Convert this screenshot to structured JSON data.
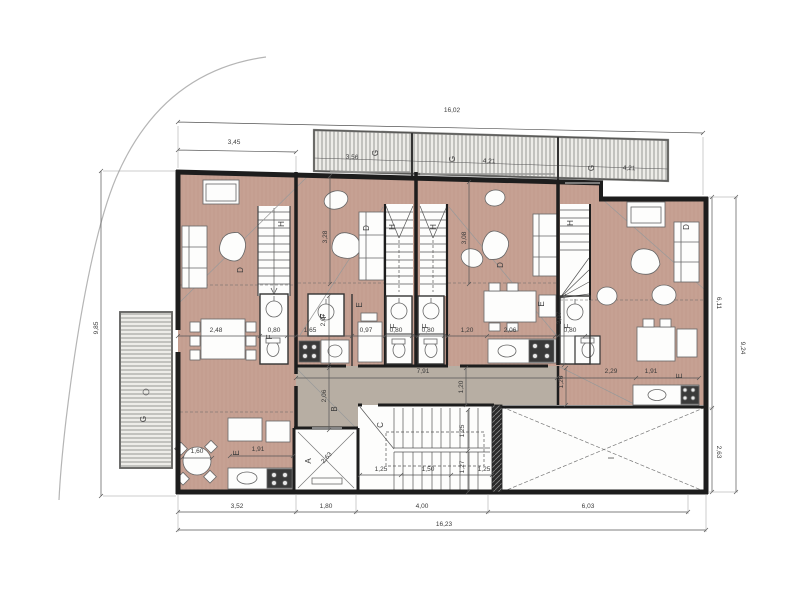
{
  "meta": {
    "type": "architectural-floor-plan",
    "view": "upper floor plan with four dwelling units, stair core, elevator and terraces"
  },
  "colors": {
    "floor_wood": "#c6a193",
    "corridor": "#b7aea3",
    "wall": "#1d1d1d",
    "terrace_bg": "#edece8",
    "hatch_line": "#8e8e8c",
    "dim_line": "#555555",
    "dim_text": "#3a3a3a",
    "white_room": "#fdfdfc",
    "site_line": "#b5b5b5"
  },
  "room_labels": [
    {
      "text": "A",
      "x": 311,
      "y": 461,
      "rot": -90
    },
    {
      "text": "B",
      "x": 337,
      "y": 409,
      "rot": -90
    },
    {
      "text": "C",
      "x": 383,
      "y": 425,
      "rot": -90
    },
    {
      "text": "D",
      "x": 243,
      "y": 270,
      "rot": -90
    },
    {
      "text": "D",
      "x": 369,
      "y": 228,
      "rot": -90
    },
    {
      "text": "D",
      "x": 503,
      "y": 265,
      "rot": -90
    },
    {
      "text": "D",
      "x": 689,
      "y": 227,
      "rot": -90
    },
    {
      "text": "E",
      "x": 239,
      "y": 453,
      "rot": -90
    },
    {
      "text": "E",
      "x": 362,
      "y": 305,
      "rot": -90
    },
    {
      "text": "E",
      "x": 544,
      "y": 304,
      "rot": -90
    },
    {
      "text": "E",
      "x": 682,
      "y": 376,
      "rot": -90
    },
    {
      "text": "F",
      "x": 272,
      "y": 337,
      "rot": -90
    },
    {
      "text": "F",
      "x": 326,
      "y": 316,
      "rot": -90
    },
    {
      "text": "F",
      "x": 396,
      "y": 326,
      "rot": -90
    },
    {
      "text": "F",
      "x": 428,
      "y": 326,
      "rot": -90
    },
    {
      "text": "F",
      "x": 570,
      "y": 326,
      "rot": -90
    },
    {
      "text": "G",
      "x": 378,
      "y": 153,
      "rot": -90
    },
    {
      "text": "G",
      "x": 455,
      "y": 159,
      "rot": -90
    },
    {
      "text": "G",
      "x": 594,
      "y": 168,
      "rot": -90
    },
    {
      "text": "G",
      "x": 146,
      "y": 419,
      "rot": -90
    },
    {
      "text": "H",
      "x": 284,
      "y": 224,
      "rot": -90
    },
    {
      "text": "H",
      "x": 395,
      "y": 227,
      "rot": -90
    },
    {
      "text": "H",
      "x": 436,
      "y": 227,
      "rot": -90
    },
    {
      "text": "H",
      "x": 573,
      "y": 223,
      "rot": -90
    },
    {
      "text": "I",
      "x": 614,
      "y": 458,
      "rot": -90
    }
  ],
  "dim_labels": [
    {
      "text": "16,02",
      "x": 452,
      "y": 112,
      "rot": 1
    },
    {
      "text": "3,45",
      "x": 234,
      "y": 144,
      "rot": 1
    },
    {
      "text": "3,56",
      "x": 352,
      "y": 159,
      "rot": 2
    },
    {
      "text": "4,21",
      "x": 489,
      "y": 163,
      "rot": 2
    },
    {
      "text": "4,21",
      "x": 629,
      "y": 170,
      "rot": 2
    },
    {
      "text": "9,85",
      "x": 98,
      "y": 328,
      "rot": -90
    },
    {
      "text": "6,11",
      "x": 717,
      "y": 303,
      "rot": 90
    },
    {
      "text": "9,24",
      "x": 741,
      "y": 348,
      "rot": 90
    },
    {
      "text": "2,63",
      "x": 717,
      "y": 452,
      "rot": 90
    },
    {
      "text": "3,52",
      "x": 237,
      "y": 508,
      "rot": 0
    },
    {
      "text": "1,80",
      "x": 326,
      "y": 508,
      "rot": 0
    },
    {
      "text": "4,00",
      "x": 422,
      "y": 508,
      "rot": 0
    },
    {
      "text": "6,03",
      "x": 588,
      "y": 508,
      "rot": 0
    },
    {
      "text": "16,23",
      "x": 444,
      "y": 526,
      "rot": 0
    },
    {
      "text": "2,48",
      "x": 216,
      "y": 332,
      "rot": 0
    },
    {
      "text": "0,80",
      "x": 274,
      "y": 332,
      "rot": 0
    },
    {
      "text": "1,65",
      "x": 310,
      "y": 332,
      "rot": 0
    },
    {
      "text": "0,97",
      "x": 366,
      "y": 332,
      "rot": 0
    },
    {
      "text": "0,80",
      "x": 396,
      "y": 332,
      "rot": 0
    },
    {
      "text": "0,80",
      "x": 428,
      "y": 332,
      "rot": 0
    },
    {
      "text": "1,20",
      "x": 467,
      "y": 332,
      "rot": 0
    },
    {
      "text": "2,06",
      "x": 510,
      "y": 332,
      "rot": 0
    },
    {
      "text": "0,80",
      "x": 570,
      "y": 332,
      "rot": 0
    },
    {
      "text": "2,07",
      "x": 325,
      "y": 320,
      "rot": -90
    },
    {
      "text": "2,07",
      "x": 561,
      "y": 318,
      "rot": -90
    },
    {
      "text": "3,28",
      "x": 327,
      "y": 237,
      "rot": -90
    },
    {
      "text": "3,08",
      "x": 466,
      "y": 238,
      "rot": -90
    },
    {
      "text": "7,91",
      "x": 423,
      "y": 373,
      "rot": 0
    },
    {
      "text": "1,20",
      "x": 463,
      "y": 387,
      "rot": -90
    },
    {
      "text": "1,20",
      "x": 563,
      "y": 382,
      "rot": -90
    },
    {
      "text": "2,06",
      "x": 326,
      "y": 396,
      "rot": -90
    },
    {
      "text": "2,29",
      "x": 611,
      "y": 373,
      "rot": 0
    },
    {
      "text": "1,91",
      "x": 651,
      "y": 373,
      "rot": 0
    },
    {
      "text": "1,91",
      "x": 258,
      "y": 451,
      "rot": 0
    },
    {
      "text": "1,60",
      "x": 197,
      "y": 453,
      "rot": 0
    },
    {
      "text": "1,25",
      "x": 381,
      "y": 471,
      "rot": 0
    },
    {
      "text": "1,50",
      "x": 428,
      "y": 471,
      "rot": 0
    },
    {
      "text": "1,25",
      "x": 484,
      "y": 471,
      "rot": 0
    },
    {
      "text": "1,25",
      "x": 464,
      "y": 431,
      "rot": -90
    },
    {
      "text": "1,27",
      "x": 464,
      "y": 467,
      "rot": -90
    },
    {
      "text": "2,63",
      "x": 328,
      "y": 459,
      "rot": -48
    }
  ]
}
